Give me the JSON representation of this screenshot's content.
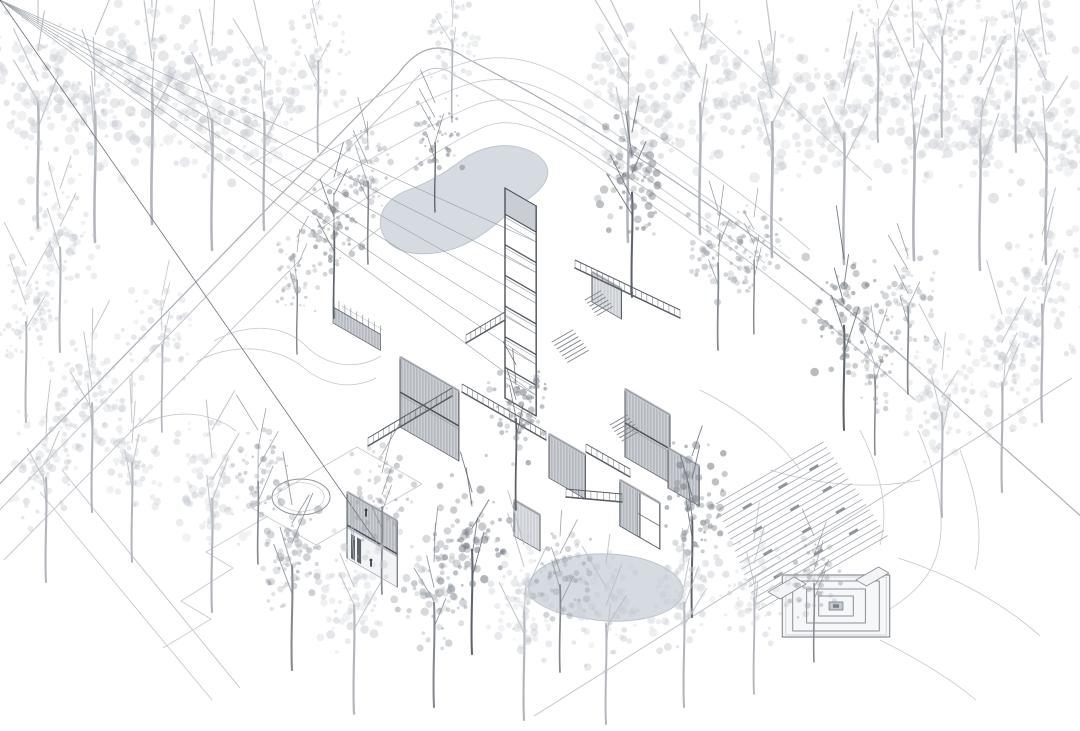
{
  "meta": {
    "description": "Axonometric architectural site illustration: cluster of flat-roofed pavilions with a stair tower, ponds, stepped amphitheater plaza and surrounding sketched trees",
    "canvas": {
      "w": 1080,
      "h": 731
    }
  },
  "palette": {
    "bg": "#ffffff",
    "line": "#8f949b",
    "lineDark": "#4a4f56",
    "lineLight": "#c6cad0",
    "roof": "#e3e6ea",
    "fascia": "#c6cbd1",
    "ribBg": "#b6bac0",
    "ribLine": "#d8dbdf",
    "ribLightBg": "#cdd1d6",
    "ribLightLine": "#e6e8eb",
    "glassBg": "#edeff2",
    "mullion": "#474c52",
    "mullionLight": "#5d6368",
    "glassShade": "#8f959c",
    "openWall": "#f4f5f7",
    "water": "#d4dae1",
    "waterEdge": "#b7bfc8",
    "steps": "#a8adb4",
    "seat": "#8e949b",
    "road": "#a9aeb5",
    "roadLight": "#bfc3c9",
    "contour": "#c7cbd1",
    "terrain": "#c3c7cd",
    "platform": "#8b9097",
    "figure": "#3c4147",
    "treeLight": "#c6cad0",
    "treeMid": "#9ba1a9",
    "treeDark": "#7b818a",
    "trunkLight": "#b2b6bc",
    "trunkMid": "#84898f",
    "trunkDark": "#5d636a"
  },
  "scene": {
    "roads": [
      {
        "d": "M -14 498 L 398 74 Q 428 32 466 58 C 640 148 810 268 948 398 C 985 432 1030 470 1085 520",
        "w": 1.2,
        "tone": "road"
      },
      {
        "d": "M -12 522 L 408 88 Q 430 56 456 76 C 620 162 780 275 915 400",
        "w": 1.0,
        "tone": "roadLight"
      },
      {
        "d": "M 4 560 L 302 258",
        "w": 0.9,
        "tone": "roadLight"
      },
      {
        "d": "M 1072 378 L 534 716",
        "w": 1.0,
        "tone": "roadLight"
      },
      {
        "d": "M 700 22 L 872 180",
        "w": 0.8,
        "tone": "roadLight"
      },
      {
        "d": "M 62 470 L 240 688",
        "w": 0.9,
        "tone": "roadLight"
      },
      {
        "d": "M 40 492 L 212 700",
        "w": 0.8,
        "tone": "roadLight"
      }
    ],
    "contours": [
      "M 250 165 C 320 120 420 75 468 62 C 520 48 560 70 610 105 C 680 150 760 205 810 250",
      "M 270 186 C 340 141 430 96 472 83 C 515 71 555 91 600 123 C 665 169 735 216 790 259",
      "M 294 206 C 360 163 440 119 478 104 C 515 91 550 109 592 139 C 650 181 715 226 765 263",
      "M 320 229 C 380 189 450 141 484 127 C 512 115 545 129 585 157 C 635 193 690 233 740 269",
      "M 350 251 C 400 213 460 166 492 151"
    ],
    "terrain": [
      "M 214 341 C 250 321 286 326 306 346 C 326 366 356 371 381 356",
      "M 196 362 C 236 340 280 348 304 368 C 326 386 352 390 376 378",
      "M 130 431 C 170 406 210 411 236 431",
      "M 268 516 L 206 552 L 233 568 L 181 601 L 211 619 L 163 648",
      "M 252 508 L 357 447 L 422 484 L 316 545 Z",
      "M 898 558 C 948 574 1000 600 1040 636",
      "M 880 640 C 920 660 952 680 976 700",
      "M 918 430 C 935 470 950 520 935 560 C 925 585 905 600 885 612",
      "M 860 430 C 880 470 890 510 880 545",
      "M 960 450 C 975 490 985 530 975 570",
      "M 770 470 C 820 485 870 490 920 480",
      "M 700 390 C 740 410 780 440 800 470"
    ],
    "ponds": [
      "M 388 242 C 372 222 382 200 408 190 C 430 182 446 172 462 160 C 478 148 502 142 522 148 C 542 154 552 166 546 180 C 540 194 522 202 510 212 C 494 226 478 240 456 248 C 430 257 402 256 388 242 Z",
      "M 530 596 C 524 580 538 564 566 558 C 594 551 630 553 655 563 C 680 573 690 589 678 603 C 664 618 628 624 596 620 C 566 616 542 610 530 596 Z"
    ],
    "circle": {
      "cx": 301,
      "cy": 497,
      "rx": 29,
      "ry": 18
    },
    "plaza": {
      "steps": {
        "x": 716,
        "y": 504,
        "n": 19,
        "ddx": 2.35,
        "ddy": 5.9,
        "len0": 124,
        "dlen": 1.4
      },
      "platform": {
        "cx": 836,
        "cy": 606,
        "rings": [
          62,
          50,
          34,
          20
        ],
        "inner": 8,
        "tabs": [
          {
            "ox": 768,
            "oy": 592,
            "a": 14,
            "b": 30
          },
          {
            "ox": 856,
            "oy": 580,
            "a": 12,
            "b": 26
          }
        ]
      }
    },
    "buildings": [
      {
        "id": "north-deck",
        "kind": "deck",
        "ox": 333,
        "oy": 307,
        "a": 55,
        "b": 143,
        "dots": [
          0.3,
          0.45,
          0.6,
          0.75
        ]
      },
      {
        "id": "north-court",
        "kind": "box",
        "ox": 592,
        "oy": 272,
        "a": 34,
        "b": 100,
        "h": 30,
        "stories": 1,
        "light": true,
        "roofRail": true,
        "shades": [
          [
            0.3,
            0.5
          ]
        ]
      },
      {
        "id": "stair-tower",
        "kind": "tower",
        "ox": 505,
        "oy": 188,
        "a": 36,
        "b": 42,
        "h": 210,
        "floors": 6,
        "cap": 26
      },
      {
        "id": "center-house",
        "kind": "box",
        "ox": 400,
        "oy": 357,
        "a": 68,
        "b": 120,
        "h": 70,
        "stories": 2,
        "shades": [
          [
            0.08,
            0.3
          ],
          [
            0.62,
            0.78
          ]
        ]
      },
      {
        "id": "east-house",
        "kind": "box",
        "ox": 625,
        "oy": 389,
        "a": 52,
        "b": 128,
        "h": 68,
        "stories": 2,
        "shades": [
          [
            0.5,
            0.68
          ]
        ]
      },
      {
        "id": "east-wing",
        "kind": "box",
        "ox": 668,
        "oy": 448,
        "a": 36,
        "b": 86,
        "h": 40,
        "stories": 1,
        "shades": [
          [
            0.2,
            0.5
          ]
        ]
      },
      {
        "id": "court-pavilion",
        "kind": "box",
        "ox": 549,
        "oy": 434,
        "a": 42,
        "b": 66,
        "h": 44,
        "stories": 1,
        "shades": [
          [
            0.1,
            0.35
          ]
        ]
      },
      {
        "id": "west-house",
        "kind": "box",
        "ox": 347,
        "oy": 492,
        "a": 58,
        "b": 188,
        "h": 66,
        "stories": 2,
        "openGround": true,
        "shades": [
          [
            0.28,
            0.42
          ]
        ]
      },
      {
        "id": "west-annex",
        "kind": "box",
        "ox": 514,
        "oy": 500,
        "a": 30,
        "b": 66,
        "h": 36,
        "stories": 1,
        "light": true,
        "shades": [
          [
            0.15,
            0.45
          ]
        ]
      },
      {
        "id": "south-pavilion",
        "kind": "open",
        "ox": 620,
        "oy": 480,
        "a": 46,
        "b": 146,
        "h": 46,
        "roofBand": true
      }
    ],
    "walkways": [
      {
        "x1": 575,
        "y1": 268,
        "x2": 680,
        "y2": 318
      },
      {
        "x1": 505,
        "y1": 320,
        "x2": 466,
        "y2": 343
      },
      {
        "x1": 452,
        "y1": 396,
        "x2": 368,
        "y2": 446
      },
      {
        "x1": 462,
        "y1": 392,
        "x2": 546,
        "y2": 440
      },
      {
        "x1": 586,
        "y1": 452,
        "x2": 630,
        "y2": 477
      },
      {
        "x1": 566,
        "y1": 497,
        "x2": 622,
        "y2": 502
      }
    ],
    "stairs": [
      {
        "x": 552,
        "y": 342,
        "n": 7,
        "len": 24,
        "dx": 2.6,
        "dy": 3.4
      },
      {
        "x": 610,
        "y": 425,
        "n": 6,
        "len": 20,
        "dx": 2.4,
        "dy": 3.2
      },
      {
        "x": 585,
        "y": 300,
        "n": 6,
        "len": 18,
        "dx": 2.4,
        "dy": 3.1
      }
    ],
    "figures": [
      [
        366,
        516
      ],
      [
        371,
        566
      ]
    ],
    "trees": [
      [
        38,
        228,
        1.45,
        "l",
        "b"
      ],
      [
        95,
        242,
        1.5,
        "l",
        "b"
      ],
      [
        152,
        224,
        1.55,
        "l",
        "b"
      ],
      [
        212,
        250,
        1.5,
        "l",
        "b"
      ],
      [
        264,
        230,
        1.35,
        "l",
        "b"
      ],
      [
        318,
        152,
        1.05,
        "l",
        "b"
      ],
      [
        452,
        122,
        0.95,
        "l",
        "b"
      ],
      [
        628,
        242,
        1.5,
        "l",
        "b"
      ],
      [
        700,
        234,
        1.5,
        "l",
        "b"
      ],
      [
        772,
        257,
        1.55,
        "l",
        "b"
      ],
      [
        844,
        264,
        1.5,
        "l",
        "b"
      ],
      [
        914,
        260,
        1.55,
        "l",
        "b"
      ],
      [
        980,
        270,
        1.5,
        "l",
        "b"
      ],
      [
        1046,
        264,
        1.5,
        "l",
        "b"
      ],
      [
        878,
        142,
        1.1,
        "l",
        "b"
      ],
      [
        942,
        137,
        1.15,
        "l",
        "b"
      ],
      [
        1016,
        152,
        1.2,
        "l",
        "b"
      ],
      [
        1042,
        422,
        1.35,
        "l",
        "b"
      ],
      [
        1002,
        492,
        1.25,
        "l",
        "b"
      ],
      [
        942,
        517,
        1.2,
        "l",
        "b"
      ],
      [
        60,
        352,
        1.2,
        "l",
        "b"
      ],
      [
        26,
        422,
        1.15,
        "l",
        "b"
      ],
      [
        92,
        512,
        1.25,
        "l",
        "b"
      ],
      [
        46,
        582,
        1.2,
        "l",
        "b"
      ],
      [
        132,
        562,
        1.15,
        "l",
        "b"
      ],
      [
        212,
        612,
        1.3,
        "l",
        "b"
      ],
      [
        162,
        432,
        1.0,
        "l",
        "b"
      ],
      [
        435,
        212,
        0.8,
        "d",
        "f"
      ],
      [
        334,
        318,
        1.0,
        "d",
        "f"
      ],
      [
        297,
        354,
        0.85,
        "m",
        "f"
      ],
      [
        368,
        264,
        0.95,
        "m",
        "f"
      ],
      [
        632,
        297,
        1.2,
        "d",
        "f"
      ],
      [
        718,
        350,
        1.0,
        "m",
        "f"
      ],
      [
        754,
        334,
        0.85,
        "m",
        "f"
      ],
      [
        844,
        430,
        1.2,
        "d",
        "f"
      ],
      [
        908,
        394,
        1.0,
        "m",
        "f"
      ],
      [
        875,
        455,
        0.9,
        "m",
        "f"
      ],
      [
        516,
        510,
        1.05,
        "d",
        "f"
      ],
      [
        472,
        654,
        1.2,
        "d",
        "f"
      ],
      [
        560,
        672,
        1.0,
        "m",
        "f"
      ],
      [
        692,
        617,
        1.15,
        "d",
        "f"
      ],
      [
        258,
        564,
        0.95,
        "m",
        "f"
      ],
      [
        382,
        594,
        1.0,
        "m",
        "f"
      ],
      [
        292,
        670,
        1.2,
        "m",
        "f"
      ],
      [
        354,
        714,
        1.25,
        "l",
        "f"
      ],
      [
        434,
        707,
        1.2,
        "m",
        "f"
      ],
      [
        524,
        720,
        1.25,
        "l",
        "f"
      ],
      [
        606,
        724,
        1.15,
        "l",
        "f"
      ],
      [
        684,
        707,
        1.2,
        "l",
        "f"
      ],
      [
        754,
        694,
        1.1,
        "l",
        "f"
      ],
      [
        814,
        662,
        0.9,
        "m",
        "f"
      ]
    ]
  }
}
